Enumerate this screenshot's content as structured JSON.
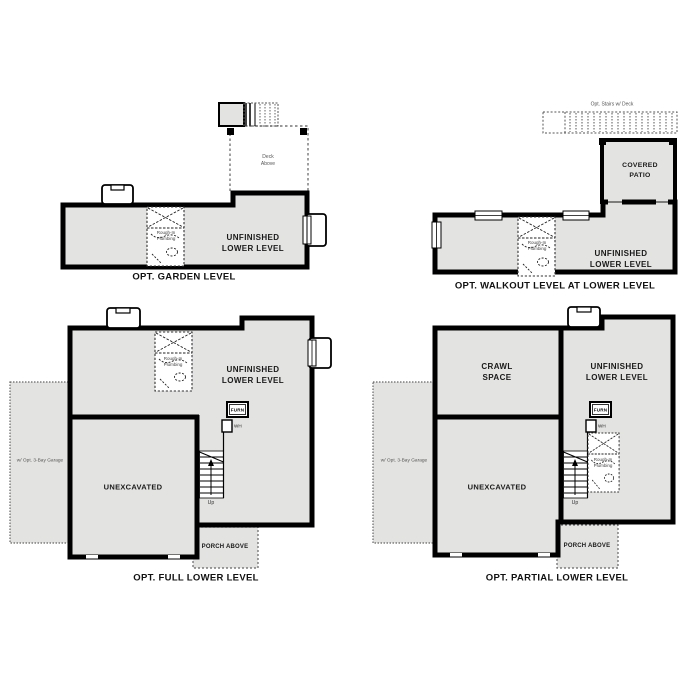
{
  "document": {
    "background": "#ffffff"
  },
  "colors": {
    "wall": "#000000",
    "room_fill": "#e3e3e1",
    "dashed_outline": "#666666",
    "label_dark": "#111111",
    "label_gray": "#555555"
  },
  "plans": {
    "garden": {
      "caption": "OPT. GARDEN LEVEL",
      "unfinished_label": "UNFINISHED\nLOWER LEVEL",
      "deck_label": "Deck\nAbove",
      "rough_in_label": "Rough-In\nPlumbing"
    },
    "walkout": {
      "caption": "OPT. WALKOUT LEVEL AT LOWER LEVEL",
      "stairs_label": "Opt. Stairs w/ Deck",
      "covered_patio_label": "COVERED\nPATIO",
      "unfinished_label": "UNFINISHED\nLOWER LEVEL",
      "rough_in_label": "Rough-In\nPlumbing"
    },
    "full": {
      "caption": "OPT. FULL LOWER LEVEL",
      "unfinished_label": "UNFINISHED\nLOWER LEVEL",
      "unexcavated_label": "UNEXCAVATED",
      "garage_label": "w/ Opt. 3-Bay Garage",
      "porch_label": "PORCH ABOVE",
      "furnace_label": "FURN",
      "water_heater_label": "WH",
      "up_label": "Up",
      "rough_in_label": "Rough-In\nPlumbing"
    },
    "partial": {
      "caption": "OPT. PARTIAL LOWER LEVEL",
      "crawl_space_label": "CRAWL\nSPACE",
      "unfinished_label": "UNFINISHED\nLOWER LEVEL",
      "unexcavated_label": "UNEXCAVATED",
      "garage_label": "w/ Opt. 3-Bay Garage",
      "porch_label": "PORCH ABOVE",
      "furnace_label": "FURN",
      "water_heater_label": "WH",
      "up_label": "Up",
      "rough_in_label": "Rough-In\nPlumbing"
    }
  }
}
